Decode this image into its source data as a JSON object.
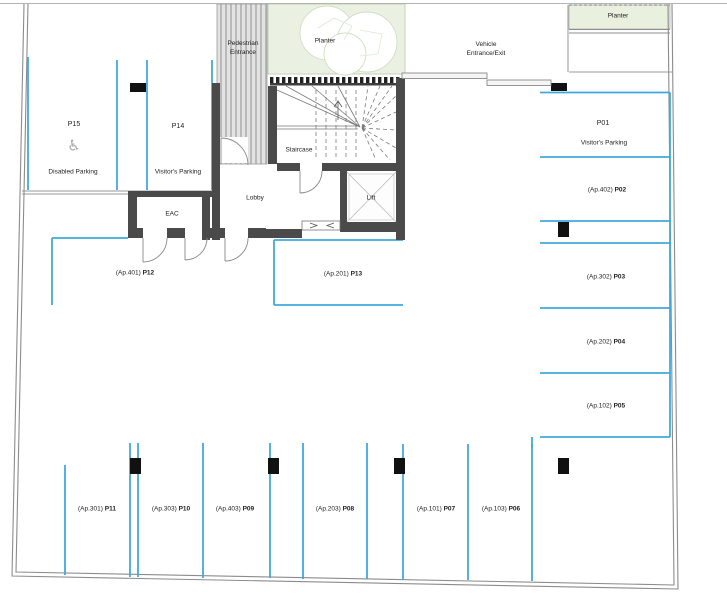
{
  "plan": {
    "title": "Basement parking floor plan",
    "colors": {
      "stall_line": "#3fa9dc",
      "wall": "#4a4a4a",
      "planter_fill": "#ebf1e2",
      "boundary_line": "#8c8c8c",
      "column": "#111111"
    },
    "entrances": {
      "pedestrian": "Pedestrian\nEntrance",
      "vehicle": "Vehicle\nEntrance/Exit"
    },
    "planters": {
      "center": "Planter",
      "right": "Planter"
    },
    "rooms": {
      "staircase": "Staircase",
      "lobby": "Lobby",
      "lift": "Lift",
      "eac": "EAC"
    },
    "icons": {
      "disabled_parking_icon": "♿"
    },
    "stalls": {
      "p01": {
        "id": "P01",
        "note": "Visitor's Parking"
      },
      "p02": {
        "ap": "(Ap.402)",
        "id": "P02"
      },
      "p03": {
        "ap": "(Ap.302)",
        "id": "P03"
      },
      "p04": {
        "ap": "(Ap.202)",
        "id": "P04"
      },
      "p05": {
        "ap": "(Ap.102)",
        "id": "P05"
      },
      "p06": {
        "ap": "(Ap.103)",
        "id": "P06"
      },
      "p07": {
        "ap": "(Ap.101)",
        "id": "P07"
      },
      "p08": {
        "ap": "(Ap.203)",
        "id": "P08"
      },
      "p09": {
        "ap": "(Ap.403)",
        "id": "P09"
      },
      "p10": {
        "ap": "(Ap.303)",
        "id": "P10"
      },
      "p11": {
        "ap": "(Ap.301)",
        "id": "P11"
      },
      "p12": {
        "ap": "(Ap.401)",
        "id": "P12"
      },
      "p13": {
        "ap": "(Ap.201)",
        "id": "P13"
      },
      "p14": {
        "id": "P14",
        "note": "Visitor's Parking"
      },
      "p15": {
        "id": "P15",
        "note": "Disabled Parking"
      }
    }
  }
}
